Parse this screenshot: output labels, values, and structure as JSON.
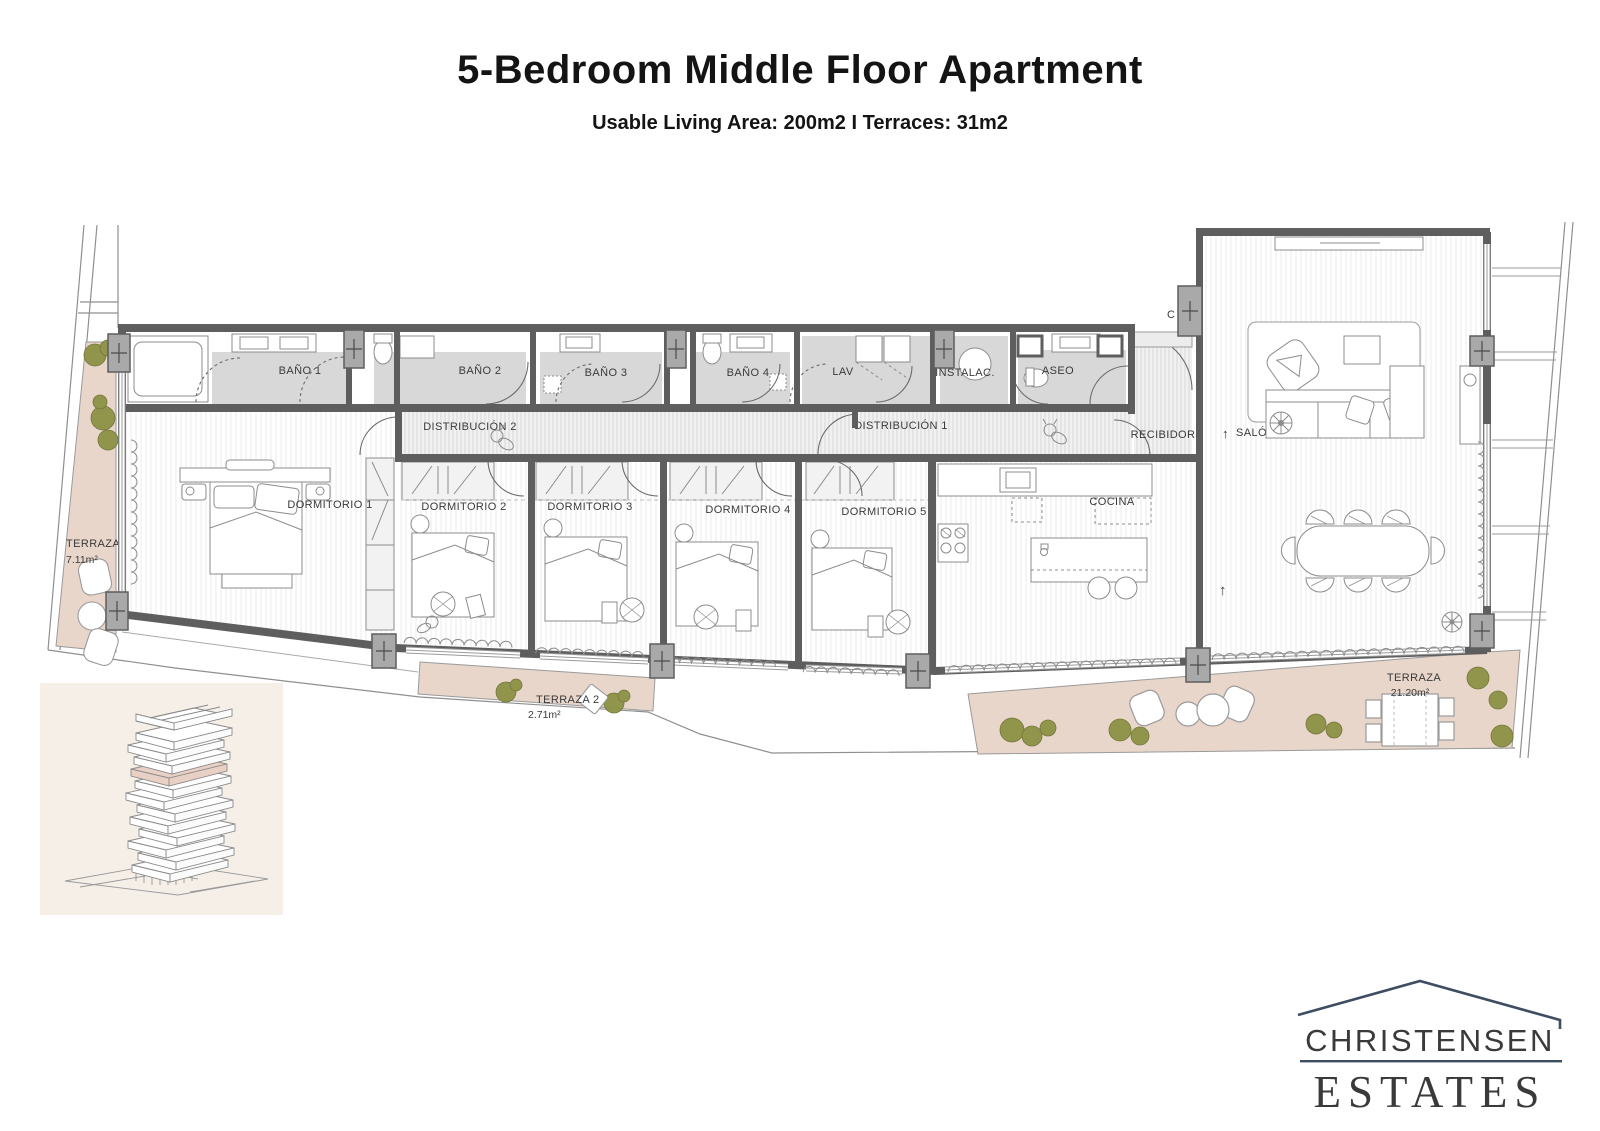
{
  "header": {
    "title": "5-Bedroom Middle Floor Apartment",
    "subtitle": "Usable Living Area: 200m2 I Terraces: 31m2"
  },
  "plan": {
    "rooms": {
      "bano1": "BAÑO 1",
      "bano2": "BAÑO 2",
      "bano3": "BAÑO 3",
      "bano4": "BAÑO 4",
      "lav": "LAV",
      "instalac": "INSTALAC.",
      "aseo": "ASEO",
      "closet": "C",
      "distribucion2": "DISTRIBUCIÓN 2",
      "distribucion1": "DISTRIBUCIÓN 1",
      "recibidor": "RECIBIDOR",
      "salon": "SALÓN",
      "dormitorio1": "DORMITORIO 1",
      "dormitorio2": "DORMITORIO 2",
      "dormitorio3": "DORMITORIO 3",
      "dormitorio4": "DORMITORIO 4",
      "dormitorio5": "DORMITORIO 5",
      "cocina": "COCINA"
    },
    "symbols": {
      "arrow_up": "↑"
    },
    "terraces": [
      {
        "name": "TERRAZA 1",
        "area": "7.11m²"
      },
      {
        "name": "TERRAZA 2",
        "area": "2.71m²"
      },
      {
        "name": "TERRAZA",
        "area": "21.20m²"
      }
    ]
  },
  "logo": {
    "name": "CHRISTENSEN",
    "tagline": "ESTATES"
  },
  "colors": {
    "wall": "#5e5e5e",
    "terrace": "#e9d6ca",
    "plant": "#8d9246",
    "bath_floor": "#d8d8d8",
    "logo_primary": "#3f4d63",
    "logo_secondary": "#9aa8b6"
  }
}
